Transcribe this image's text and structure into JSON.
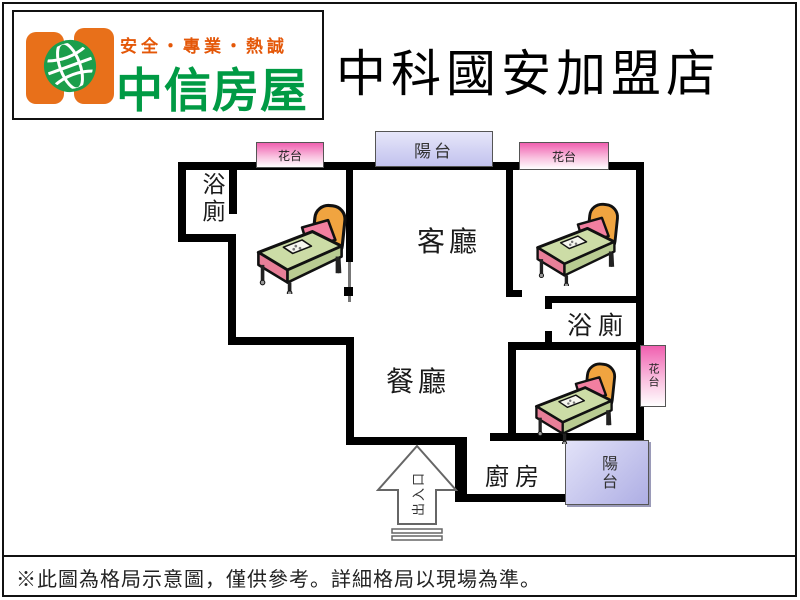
{
  "header": {
    "tagline": "安全・專業・熱誠",
    "brand": "中信房屋",
    "title": "中科國安加盟店",
    "colors": {
      "tagline_orange": "#e45708",
      "brand_green": "#009a44",
      "logo_orange": "#e8701a",
      "globe_green": "#1b9e4b"
    }
  },
  "floorplan": {
    "labels": {
      "bath1": "浴廁",
      "living": "客廳",
      "dining": "餐廳",
      "bath2": "浴廁",
      "kitchen": "廚房",
      "flower1": "花台",
      "flower2": "花台",
      "flower3": "花台",
      "balcony_top": "陽台",
      "balcony_bottom": "陽台",
      "entrance": "出入口"
    },
    "colors": {
      "wall": "#000000",
      "flower_box_pink": "#f060b0",
      "balcony_lavender": "#c2c2ee",
      "bed_blanket_green": "#ccdca6",
      "bed_pillow_pink": "#f27fa0",
      "bed_headboard_orange": "#f0a440"
    }
  },
  "footer": {
    "disclaimer": "※此圖為格局示意圖，僅供參考。詳細格局以現場為準。"
  }
}
